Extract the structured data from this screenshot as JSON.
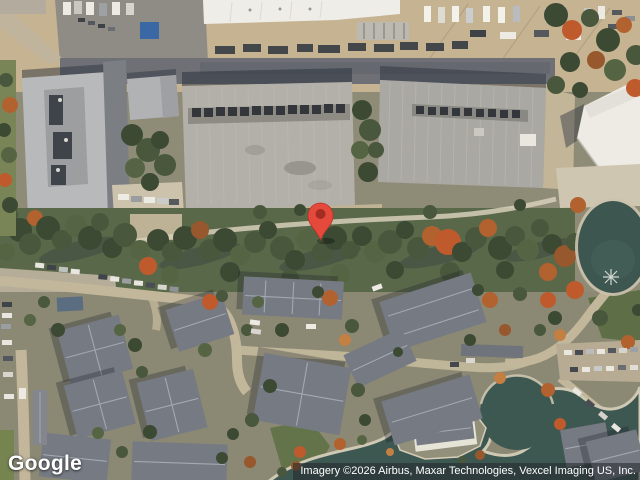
{
  "map": {
    "view_type": "satellite",
    "logo": {
      "text": "Google"
    },
    "attribution": {
      "text": "Imagery ©2026 Airbus, Maxar Technologies, Vexcel Imaging US, Inc."
    },
    "marker": {
      "color": "#E5493C",
      "dot_color": "#A42D21",
      "outline_color": "#B83227"
    }
  },
  "icons": {
    "map-pin-icon": "red teardrop map pin with dark inner dot"
  },
  "colors": {
    "water": "#3D5751",
    "tree_canopy": "#49573C",
    "pavement_tan": "#C6B392",
    "industrial_roof": "#B2B0A9",
    "residential_roof": "#757A83",
    "attribution_bg": "rgba(38,42,46,0.58)",
    "attribution_text": "#FFFFFF"
  }
}
